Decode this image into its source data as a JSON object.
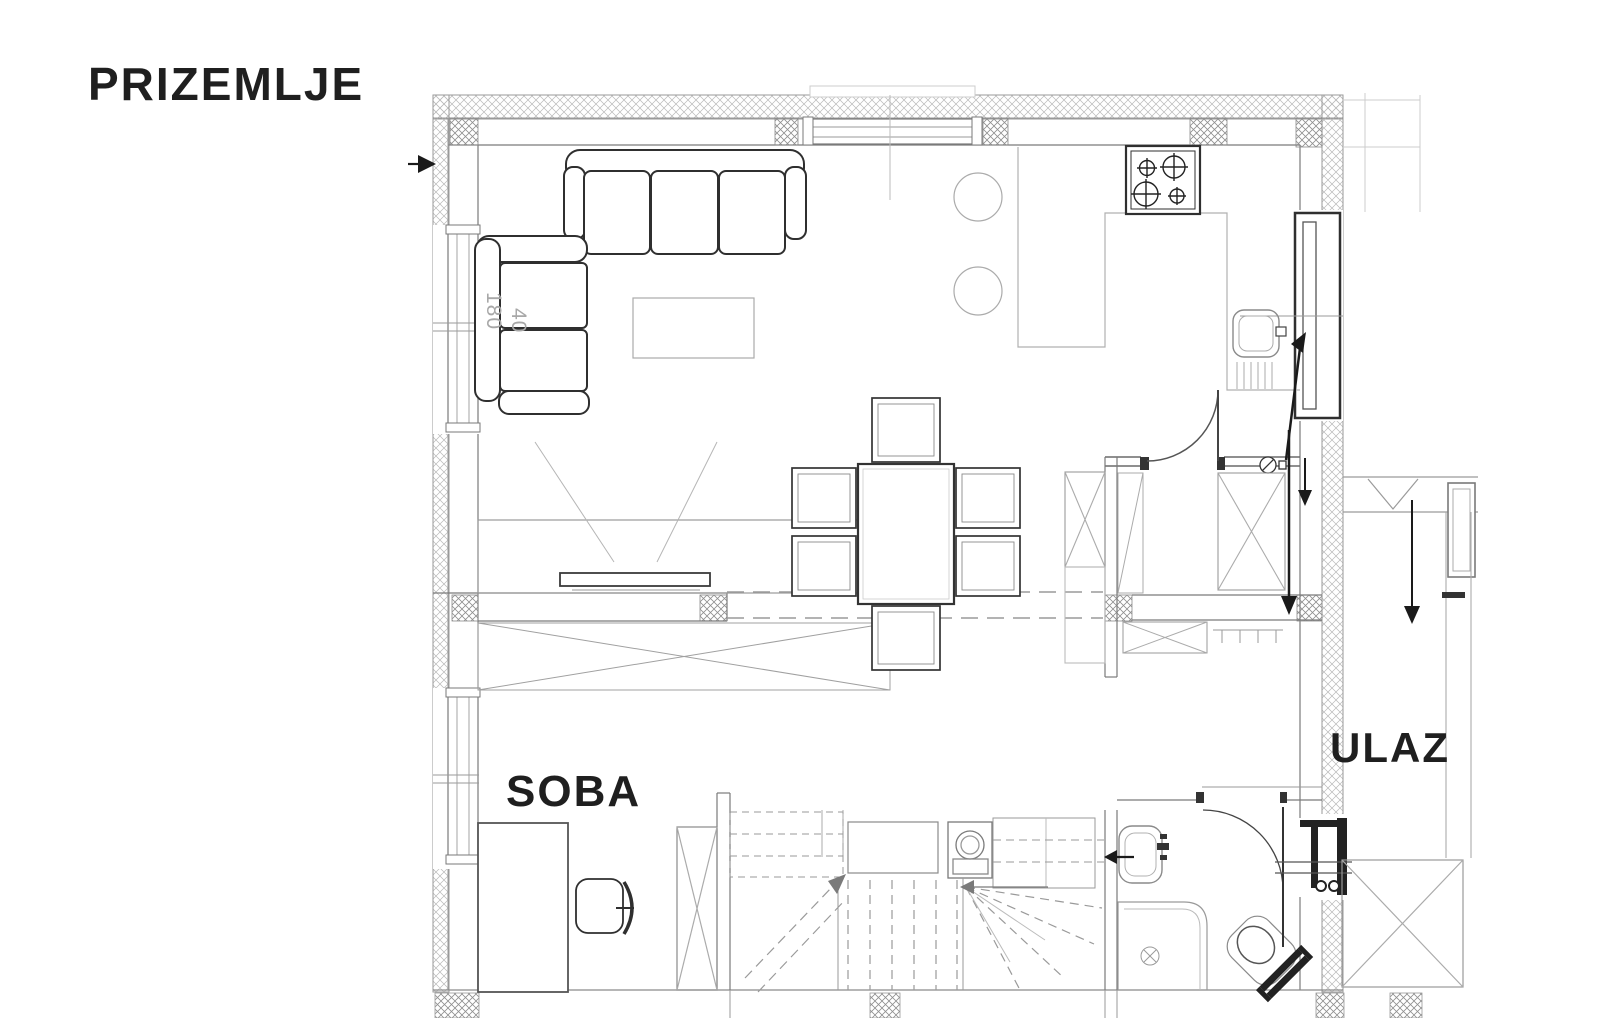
{
  "plan": {
    "title": "PRIZEMLJE",
    "rooms": {
      "room": "SOBA",
      "entrance": "ULAZ"
    },
    "dimensions": {
      "armchair_width": "180",
      "armchair_depth": "40"
    },
    "colors": {
      "ink_dark": "#1f1f1f",
      "furniture_dark": "#2f2f2f",
      "wall_line": "#7a7a7a",
      "light_line": "#b0b0b0",
      "hatch": "#909090",
      "background": "#ffffff"
    }
  }
}
